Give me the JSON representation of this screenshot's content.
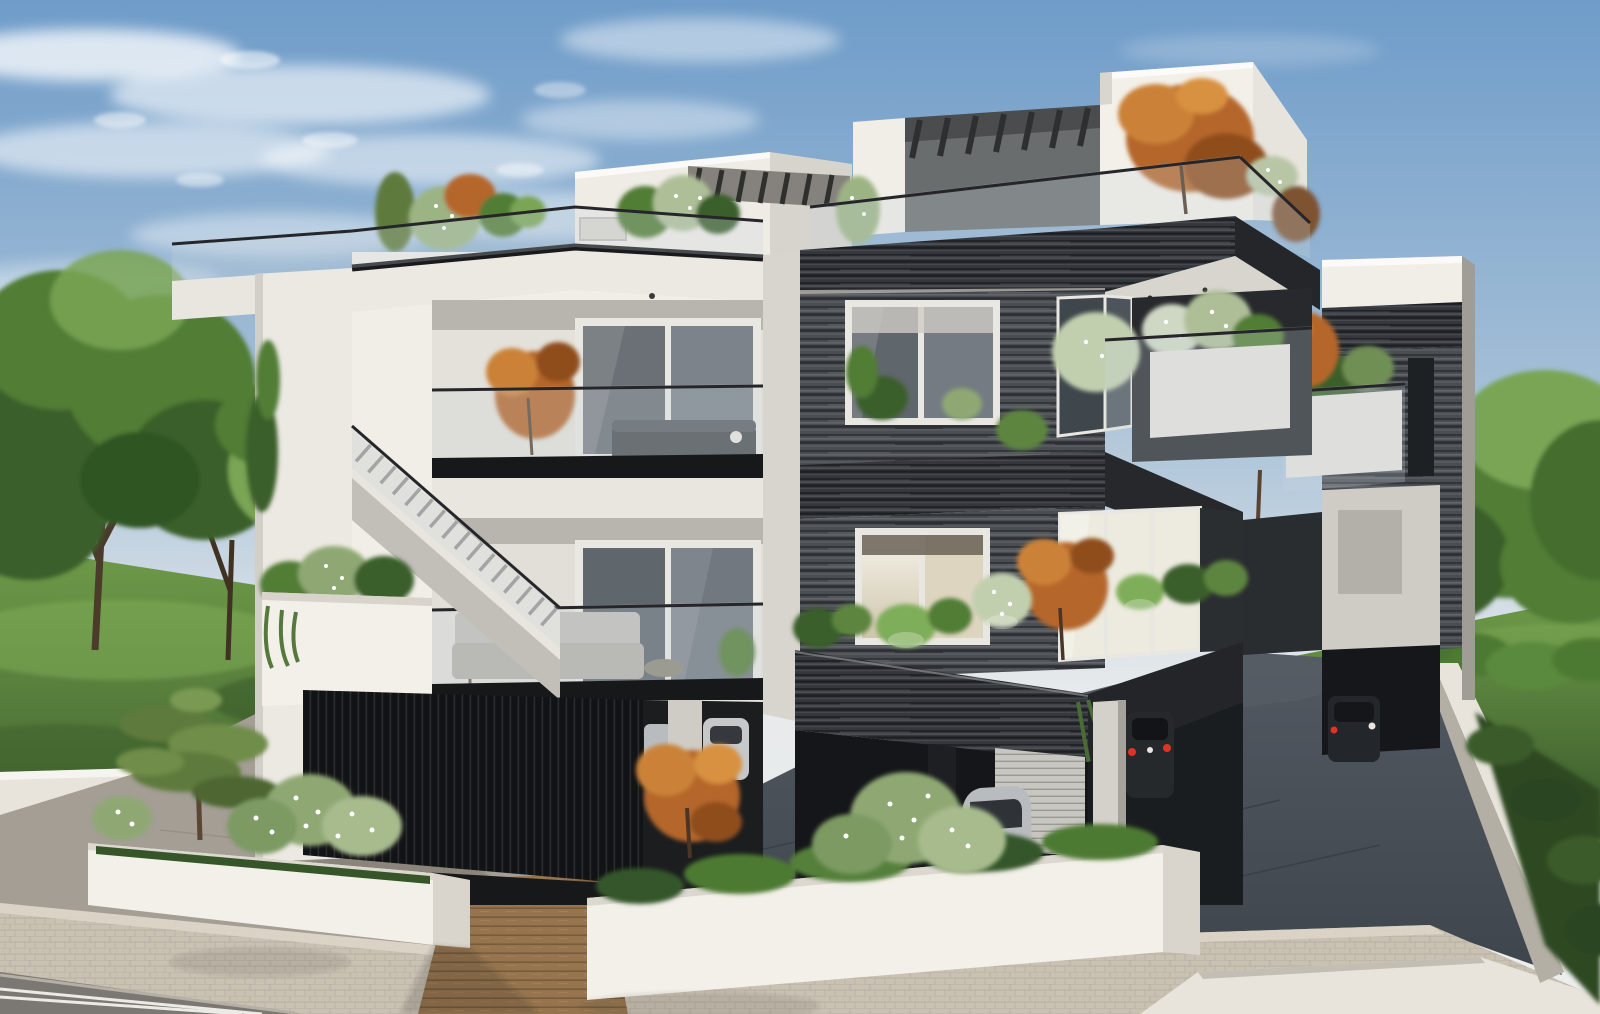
{
  "meta": {
    "type": "architectural-exterior-render",
    "description": "Daytime 3D visualization of a modern three-storey apartment building: left volume in white stucco with external staircase and glass-railed balconies, right volume clad in dark grey striped stone/wood with planted balcony edges, ground-floor parking with cars, white perimeter planter walls, paved sidewalk and road in front, green lawns and trees on both sides under a blue sky with wispy clouds.",
    "time_of_day": "day",
    "camera": "elevated three-quarter street view"
  },
  "colors": {
    "sky-top": "#6f9cc9",
    "sky-mid": "#a9c2d8",
    "sky-horizon": "#e7eaec",
    "white-wall": "#f1eee7",
    "white-wall-shade": "#d7d4cd",
    "soffit": "#b8b5af",
    "clad-base": "#4a4e53",
    "clad-dark": "#2e3134",
    "clad-light": "#6d7277",
    "clad-stripe": "#24262a",
    "fascia-black": "#17181a",
    "glass-tint": "#c8d4dc",
    "glass-dark": "#474e55",
    "window-frame": "#e9e7e1",
    "lit-warm": "#ece5d2",
    "lit-bright": "#edebdf",
    "grass": "#4e7a33",
    "grass-dark": "#36562a",
    "grass-light": "#6f9b49",
    "tree-green": "#517d36",
    "tree-green-dark": "#3a5f2a",
    "tree-green-light": "#79a554",
    "orange-tree": "#b5662c",
    "orange-light": "#cb8238",
    "orange-dark": "#8f4d1d",
    "pine-green": "#5f7a3c",
    "planter-white": "#f3f0e9",
    "planter-side": "#d9d5cd",
    "slat-wall": "#121315",
    "slat-line": "#2a2c2f",
    "driveway": "#3f454c",
    "driveway-light": "#525962",
    "flagstone": "#a49e95",
    "sidewalk": "#c9c1b2",
    "road": "#7b7772",
    "road-line": "#eceae4",
    "wood-walk": "#96754e",
    "wood-walk-dark": "#765c3c",
    "car-silver": "#b9bcbf",
    "car-dark": "#26292c",
    "taillight": "#e03325",
    "hedge": "#2e4a22",
    "boundary-wall": "#e8e4dc"
  },
  "scene_objects": [
    "sky",
    "cirrus-clouds",
    "left-lawn",
    "right-lawn",
    "left-trees",
    "right-trees",
    "perimeter-walls",
    "sidewalk",
    "road-with-double-line",
    "dark-driveway",
    "wooden-entrance-walkway",
    "white-street-planters",
    "pine-tree",
    "flowering-shrubs",
    "white-building-left",
    "external-staircase",
    "roof-terrace-plants",
    "balcony-sofa",
    "balcony-couch",
    "orange-autumn-trees",
    "dark-clad-building-right",
    "penthouse-with-pergola",
    "glass-railings",
    "lit-windows",
    "planted-balcony-planters",
    "garage-louver-doors",
    "silver-car",
    "dark-car",
    "rear-annex-block",
    "hedge-row"
  ],
  "counts": {
    "storeys": 3,
    "visible-cars": 4,
    "orange-trees": 5
  }
}
